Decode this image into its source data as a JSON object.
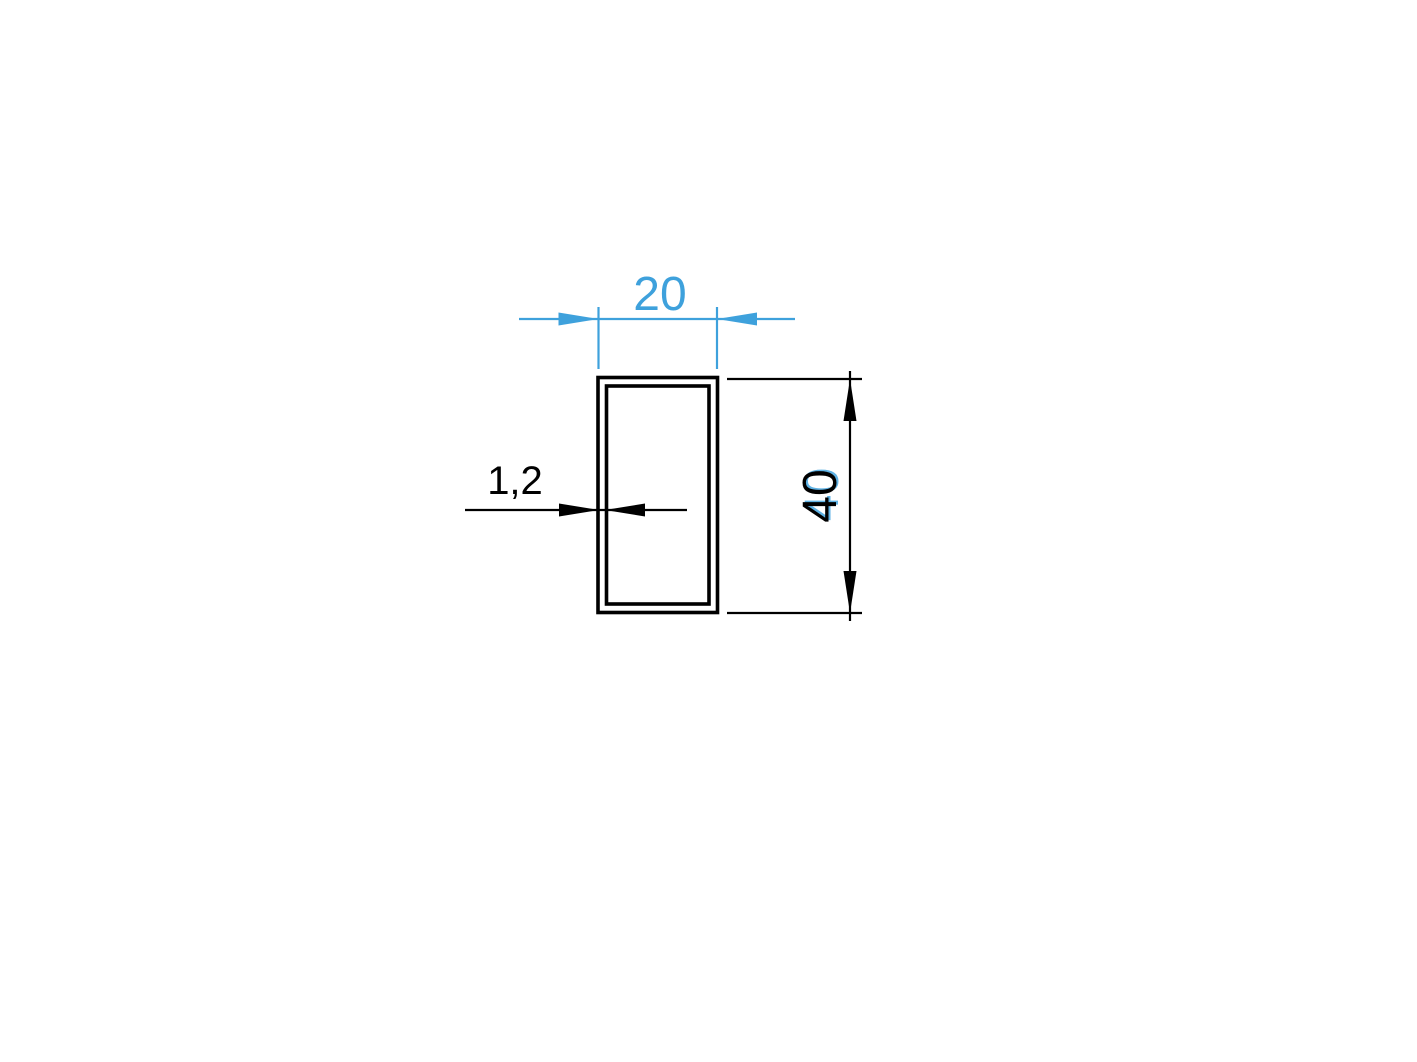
{
  "drawing": {
    "labels": {
      "width": "20",
      "height": "40",
      "thickness": "1,2"
    },
    "colors": {
      "blue": "#3EA1DC",
      "blue_ghost": "#5FB2E4",
      "black": "#000000",
      "background": "#ffffff"
    }
  }
}
